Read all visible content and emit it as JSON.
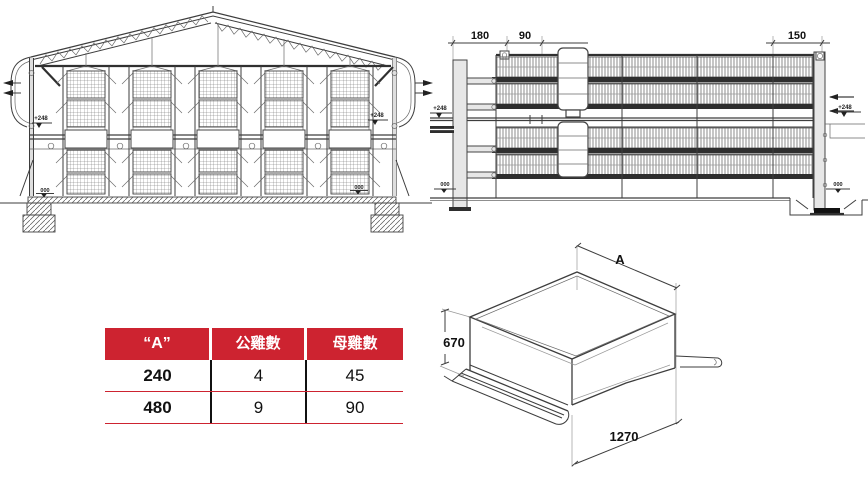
{
  "page": {
    "background": "#ffffff",
    "line_color": "#3d3d3d"
  },
  "cross_section": {
    "level_upper_left": "+248",
    "level_upper_right": "+248",
    "level_ground_left": "000",
    "level_ground_right": "000"
  },
  "elevation": {
    "dim_left_offset": "180",
    "dim_walkway": "90",
    "dim_right_offset": "150",
    "level_upper_left": "+248",
    "level_upper_right": "+248",
    "level_ground_left": "000",
    "level_ground_right": "000"
  },
  "isometric": {
    "dim_width_label": "A",
    "dim_height": "670",
    "dim_depth": "1270"
  },
  "table": {
    "accent_color": "#cd2330",
    "columns": [
      "“A”",
      "公雞數",
      "母雞數"
    ],
    "rows": [
      {
        "a": "240",
        "roosters": "4",
        "hens": "45"
      },
      {
        "a": "480",
        "roosters": "9",
        "hens": "90"
      }
    ]
  }
}
